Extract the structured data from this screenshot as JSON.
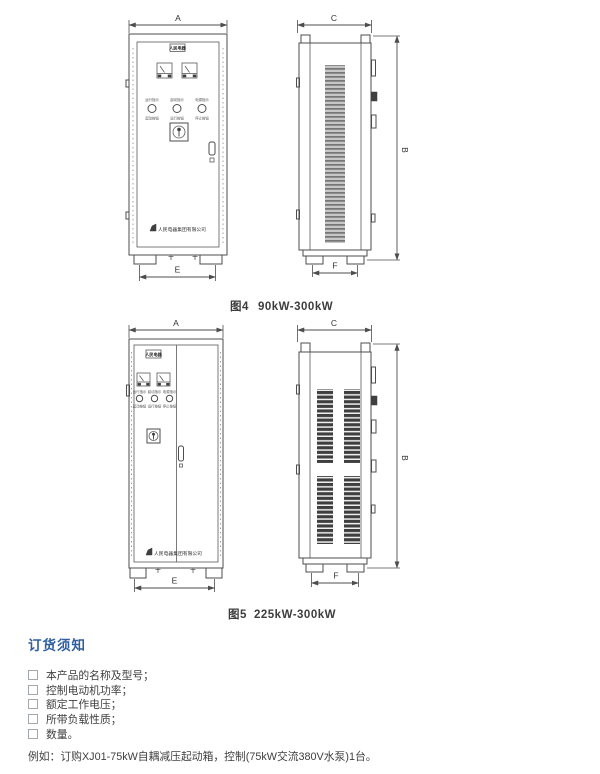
{
  "figure4": {
    "caption_label": "图4",
    "caption_range": "90kW-300kW",
    "dims": {
      "a": "A",
      "b": "B",
      "c": "C",
      "e": "E",
      "f": "F"
    },
    "front": {
      "nameplate": "人民电器",
      "indicator_labels_top": [
        "运行指示",
        "起动指示",
        "电源指示"
      ],
      "indicator_labels_bottom": [
        "起动按钮",
        "运行按钮",
        "停止按钮"
      ],
      "brand": "人民电器集团有限公司"
    }
  },
  "figure5": {
    "caption_label": "图5",
    "caption_range": "225kW-300kW",
    "dims": {
      "a": "A",
      "b": "B",
      "c": "C",
      "e": "E",
      "f": "F"
    },
    "front": {
      "nameplate": "人民电器",
      "indicator_labels_top": [
        "运行指示",
        "起动指示",
        "电源指示"
      ],
      "indicator_labels_bottom": [
        "起动按钮",
        "运行按钮",
        "停止按钮"
      ],
      "brand": "人民电器集团有限公司"
    }
  },
  "order_notice": {
    "heading": "订货须知",
    "items": [
      "本产品的名称及型号；",
      "控制电动机功率；",
      "额定工作电压；",
      "所带负载性质；",
      "数量。"
    ],
    "example": "例如：订购XJ01-75kW自耦减压起动箱，控制(75kW交流380V水泵)1台。"
  },
  "colors": {
    "line": "#4d4d4d",
    "heading_blue": "#2d5f9e",
    "text": "#3f3f3f"
  }
}
